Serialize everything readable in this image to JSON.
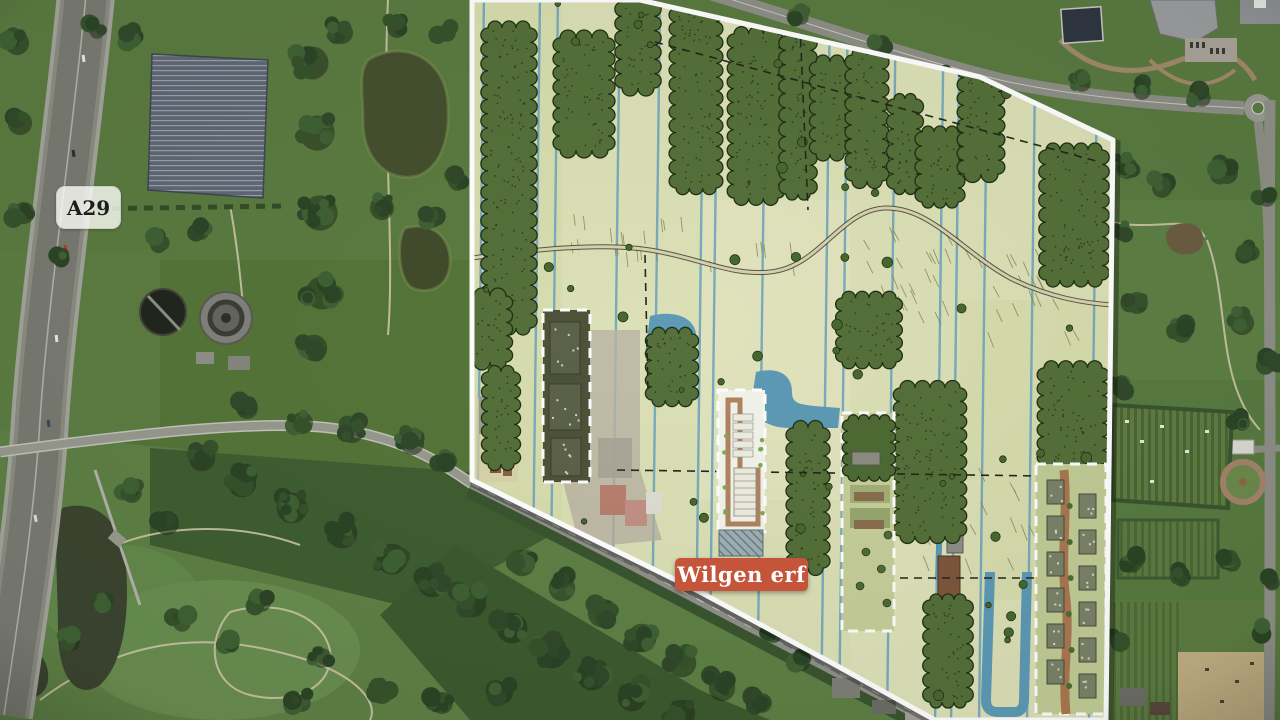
{
  "map": {
    "road_shield": {
      "label": "A29"
    },
    "site_marker": {
      "label": "Wilgen erf"
    },
    "colors": {
      "site_marker_bg": "#c4553b",
      "site_marker_text": "#ffffff",
      "road_shield_bg": "rgba(252,252,248,0.8)",
      "road_shield_text": "#1d1d1d",
      "plan_outline": "#ffffff",
      "plan_field": "#dce0b6",
      "plan_water": "#6fa6bd",
      "plan_trees": "#55703a",
      "plot_boundary_dash": "#ffffff",
      "satellite_grass": "#557539",
      "satellite_forest": "#31492a",
      "highway_asphalt": "#797b72"
    }
  }
}
